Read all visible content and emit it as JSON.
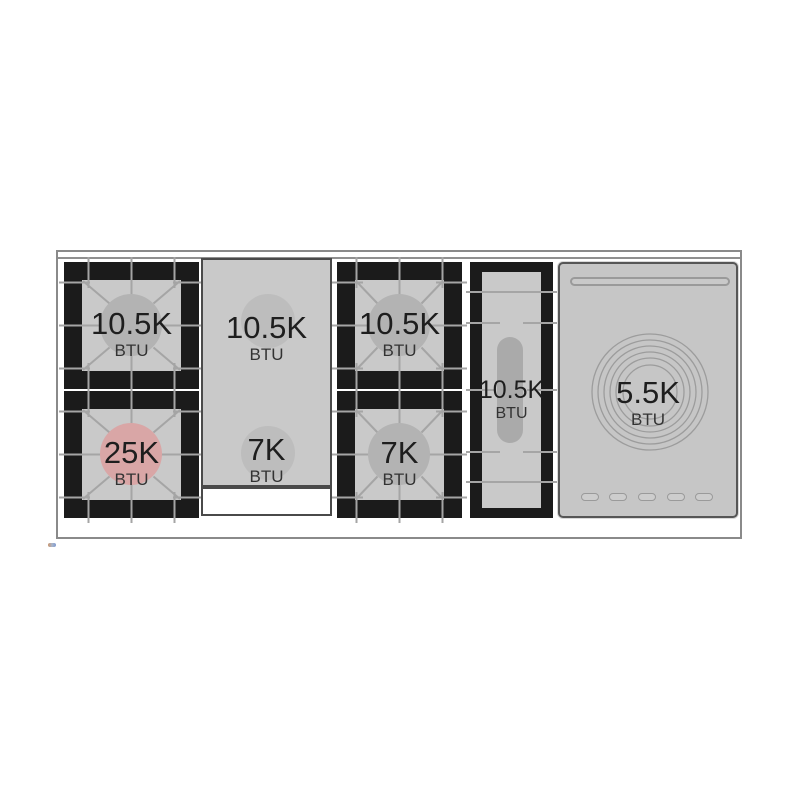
{
  "cooktop": {
    "burners": {
      "left_rear": {
        "power": "10.5K",
        "unit": "BTU"
      },
      "left_front": {
        "power": "25K",
        "unit": "BTU"
      },
      "griddle_rear": {
        "power": "10.5K",
        "unit": "BTU"
      },
      "griddle_front": {
        "power": "7K",
        "unit": "BTU"
      },
      "center_rear": {
        "power": "10.5K",
        "unit": "BTU"
      },
      "center_front": {
        "power": "7K",
        "unit": "BTU"
      },
      "oval": {
        "power": "10.5K",
        "unit": "BTU"
      },
      "simmer": {
        "power": "5.5K",
        "unit": "BTU"
      }
    },
    "highlighted_burner": "left_front",
    "colors": {
      "burner_frame_black": "#1b1b1b",
      "surface_gray": "#c9c9c9",
      "grate_line_gray": "#a5a5a5",
      "burner_circle_gray": "#b3b3b3",
      "highlight_circle_pink": "#d9a6a6",
      "label_text": "#1e1e1e",
      "panel_border": "#565656",
      "outer_frame_border": "#8a8a8a"
    }
  }
}
